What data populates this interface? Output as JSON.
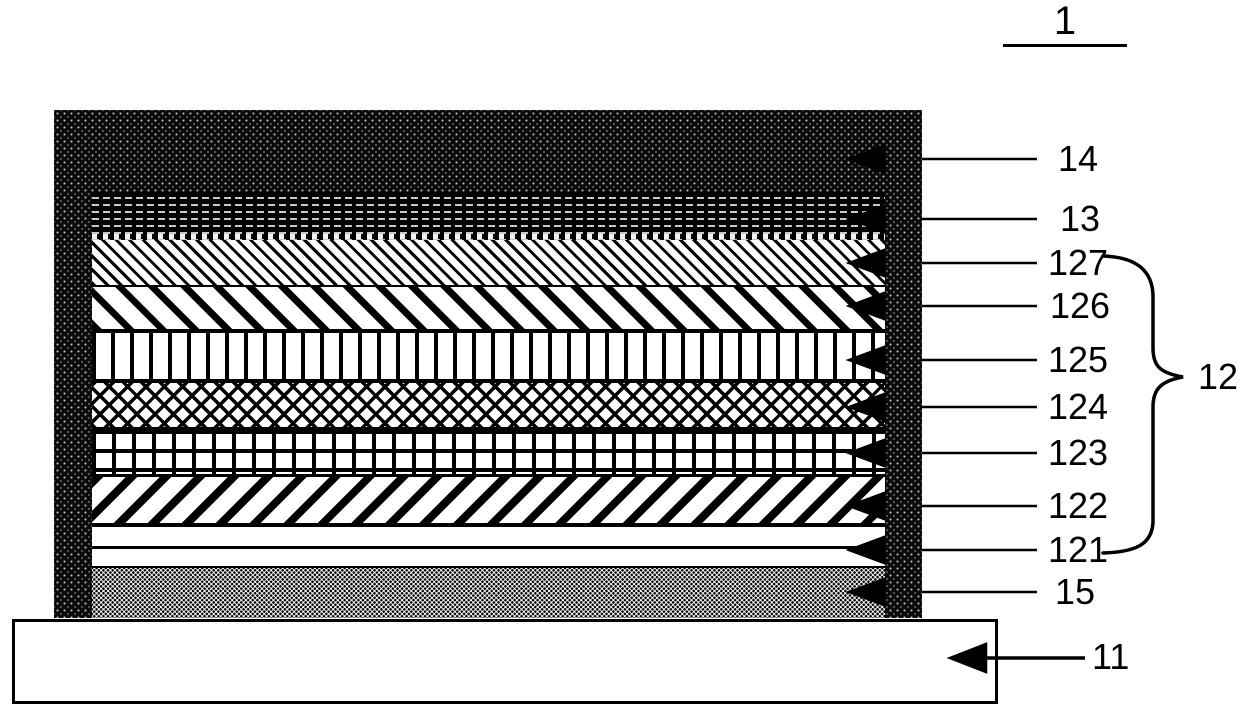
{
  "figure": {
    "number": "1",
    "group": {
      "label": "12",
      "members": [
        "121",
        "122",
        "123",
        "124",
        "125",
        "126",
        "127"
      ]
    }
  },
  "callouts": {
    "c1": "1",
    "c14": "14",
    "c13": "13",
    "c127": "127",
    "c126": "126",
    "c125": "125",
    "c124": "124",
    "c123": "123",
    "c122": "122",
    "c121": "121",
    "c15": "15",
    "c12": "12",
    "c11": "11"
  },
  "layers": [
    {
      "ref": "14",
      "pattern": "dark-stipple-top-band"
    },
    {
      "ref": "13",
      "pattern": "black-with-white-dashes"
    },
    {
      "ref": "127",
      "pattern": "fine-backslash-hatch"
    },
    {
      "ref": "126",
      "pattern": "wide-backslash-stripes"
    },
    {
      "ref": "125",
      "pattern": "vertical-bars"
    },
    {
      "ref": "124",
      "pattern": "diamond-crosshatch"
    },
    {
      "ref": "123",
      "pattern": "rectangular-grid"
    },
    {
      "ref": "122",
      "pattern": "forward-slash-stripes"
    },
    {
      "ref": "121",
      "pattern": "thin-white-layer-with-line"
    },
    {
      "ref": "15",
      "pattern": "dot-stipple"
    },
    {
      "ref": "11",
      "pattern": "plain-white-substrate"
    }
  ],
  "colors": {
    "ink": "#000000",
    "background": "#ffffff"
  }
}
